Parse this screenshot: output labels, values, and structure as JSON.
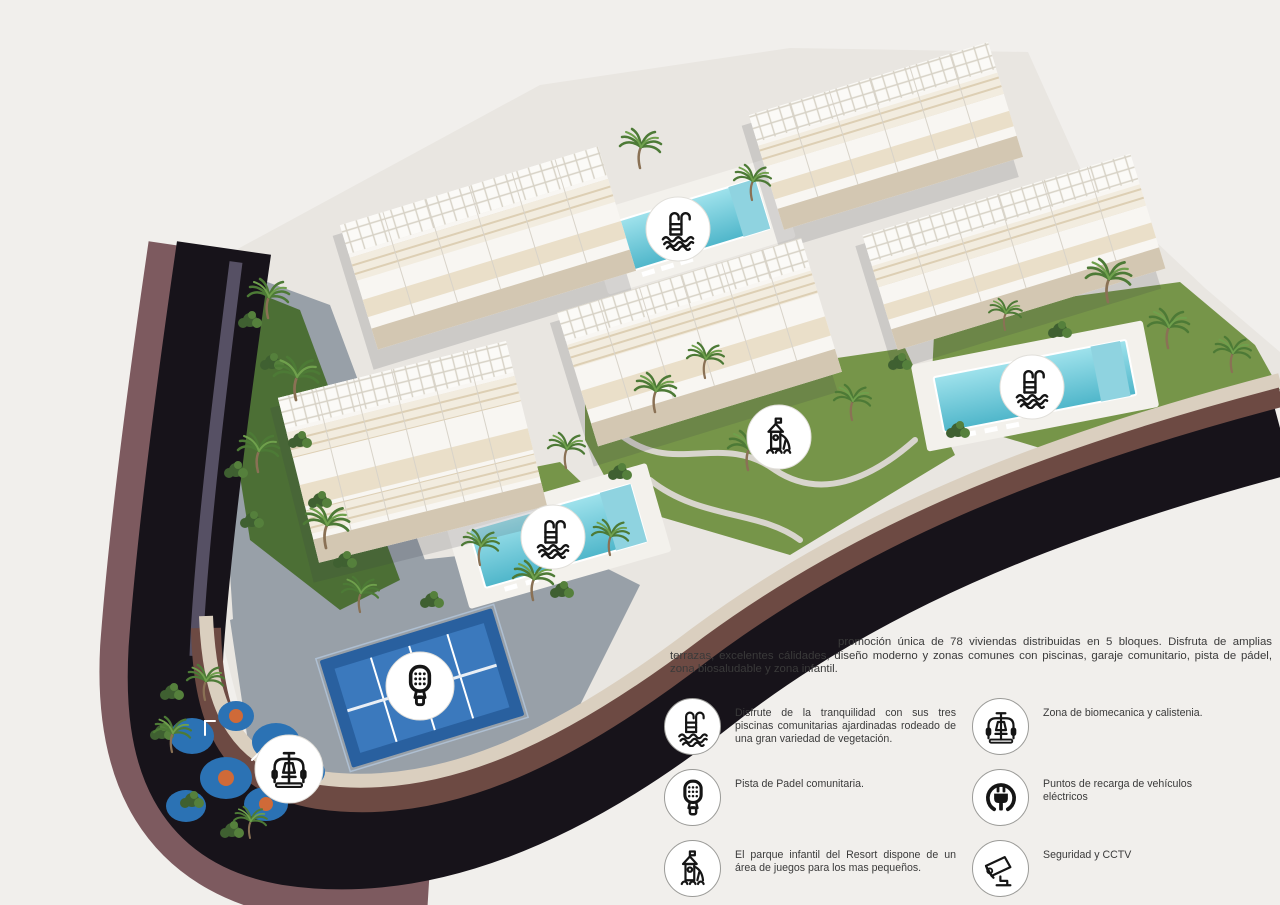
{
  "promo": {
    "paragraph": "promoción única de 78 viviendas distribuidas en 5 bloques. Disfruta de amplias terrazas, excelentes cálidades, diseño moderno y zonas comunes con piscinas, garaje comunitario, pista de pádel, zona biosaludable y zona infantil."
  },
  "legend": {
    "left": [
      {
        "icon": "pool-icon",
        "text": "Disfrute de la tranquilidad con sus tres piscinas comunitarias ajardinadas rodeado de una gran variedad de vegetación."
      },
      {
        "icon": "padel-icon",
        "text": "Pista de Padel comunitaria."
      },
      {
        "icon": "playground-icon",
        "text": "El parque infantil del Resort dispone de un área de juegos para los mas pequeños."
      }
    ],
    "right": [
      {
        "icon": "biomechanics-icon",
        "text": "Zona de biomecanica y calistenia."
      },
      {
        "icon": "ev-charging-icon",
        "text": "Puntos de recarga de vehículos eléctricos"
      },
      {
        "icon": "cctv-icon",
        "text": "Seguridad y CCTV"
      }
    ]
  },
  "site_badges": [
    {
      "icon": "pool-icon",
      "location": "top-pool"
    },
    {
      "icon": "pool-icon",
      "location": "right-pool"
    },
    {
      "icon": "pool-icon",
      "location": "center-pool"
    },
    {
      "icon": "playground-icon",
      "location": "central-garden"
    },
    {
      "icon": "padel-icon",
      "location": "padel-court"
    },
    {
      "icon": "biomechanics-icon",
      "location": "splash-playground"
    }
  ],
  "colors": {
    "background": "#f1efec",
    "text": "#3a3a3a",
    "icon": "#151515",
    "road": "#17131a",
    "outer_wall": "#7d5a5f",
    "terrace_wall": "#6d4a43",
    "stone_wall": "#dacfbf",
    "walkstrip": "#565064",
    "plate": "#e9e6e1",
    "pavement": "#98a0a8",
    "grass": "#769549",
    "grass_dark": "#4c6f35",
    "garden_path": "#d8d5cd",
    "pool_light": "#9fe2ec",
    "pool_dark": "#4fb6ca",
    "padel_outer": "#29609f",
    "padel_inner": "#3b79bd",
    "playground_blue": "#2b72b4",
    "playground_orange": "#cf6a38",
    "building_white": "#f8f6f2",
    "terrace_beige": "#eadfc9",
    "facade_beige": "#d3c7b2"
  }
}
